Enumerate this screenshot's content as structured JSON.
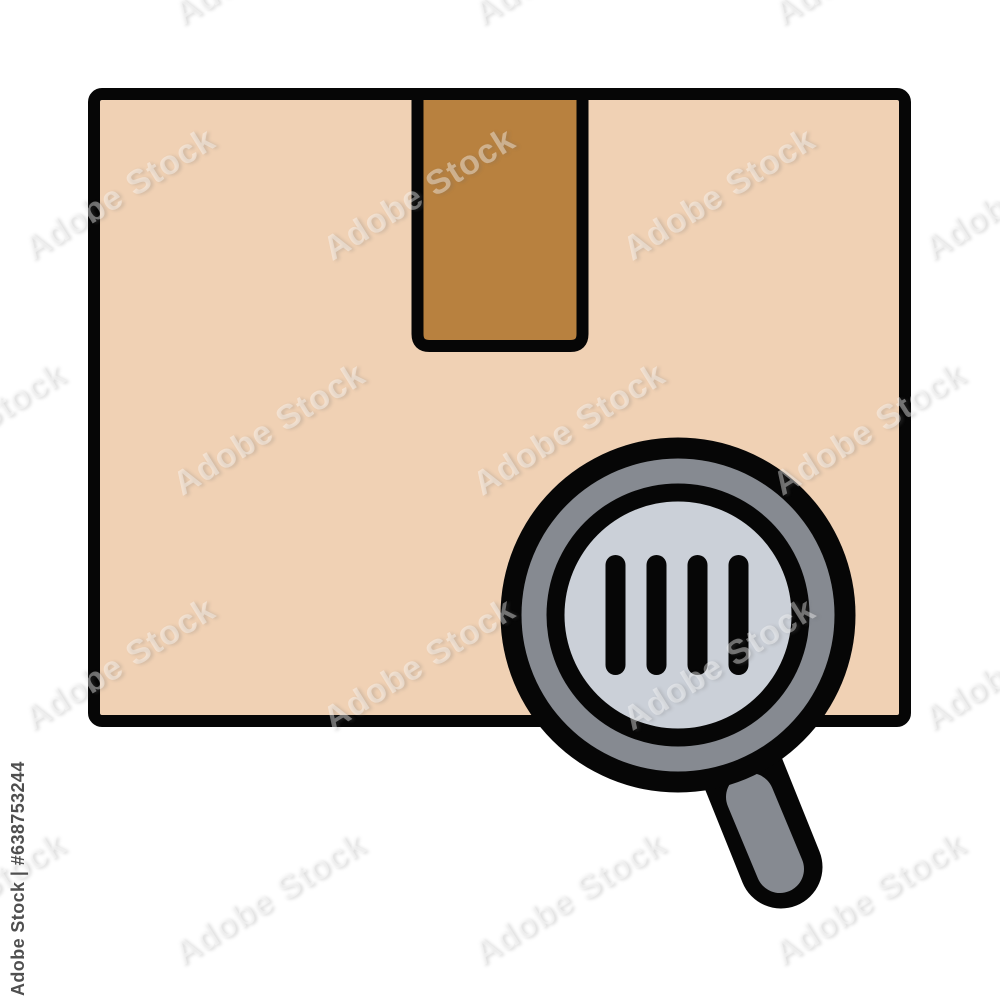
{
  "icon": {
    "name": "parcel-barcode-search-icon",
    "colors": {
      "background": "#ffffff",
      "outline": "#060606",
      "box_fill": "#f0d1b4",
      "tape_fill": "#b8813f",
      "rim_gray": "#868a91",
      "handle_gray": "#868a91",
      "lens_fill": "#cbd0d8",
      "none": "none"
    }
  },
  "watermark": {
    "tile_text": "Adobe Stock",
    "credit": "Adobe Stock | #638753244"
  }
}
